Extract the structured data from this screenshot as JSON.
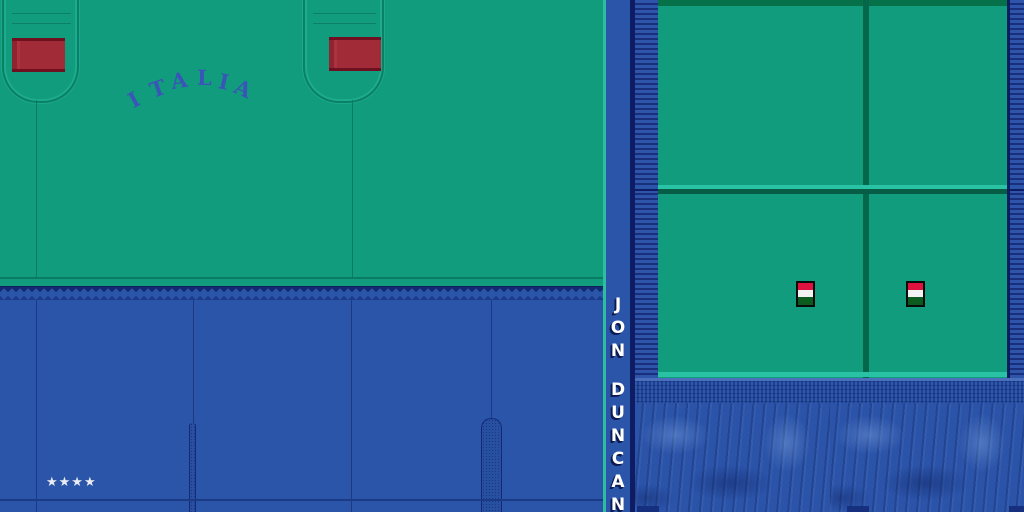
{
  "kit": {
    "team_wordmark": "ITALIA",
    "wordmark_letters": [
      "I",
      "T",
      "A",
      "L",
      "I",
      "A"
    ],
    "player_name": "JON DUNCAN",
    "player_name_letters": [
      "J",
      "O",
      "N",
      "D",
      "U",
      "N",
      "C",
      "A",
      "N"
    ],
    "star_rating": "★★★★",
    "star_count": 4
  },
  "flags": {
    "count": 2,
    "stripe_colors": [
      "#df1240",
      "#f2f2f2",
      "#0b5a1e"
    ]
  },
  "palette": {
    "jersey_green": "#129c7e",
    "jersey_green_dark": "#0a7a63",
    "trim_teal": "#2ac2a5",
    "sleeve_band_dark_green": "#067048",
    "shorts_blue": "#2a55a9",
    "seam_blue": "#1b3a85",
    "navy": "#0e1d63",
    "chest_patch_red": "#a12b37",
    "patch_edge_dark_red": "#6e1020",
    "wordmark_blue": "#3a55b8",
    "denim_blue": "#2b53a8",
    "name_text": "#ffffff",
    "name_shadow": "#0c1a52",
    "stars_white": "#ebebf3"
  }
}
